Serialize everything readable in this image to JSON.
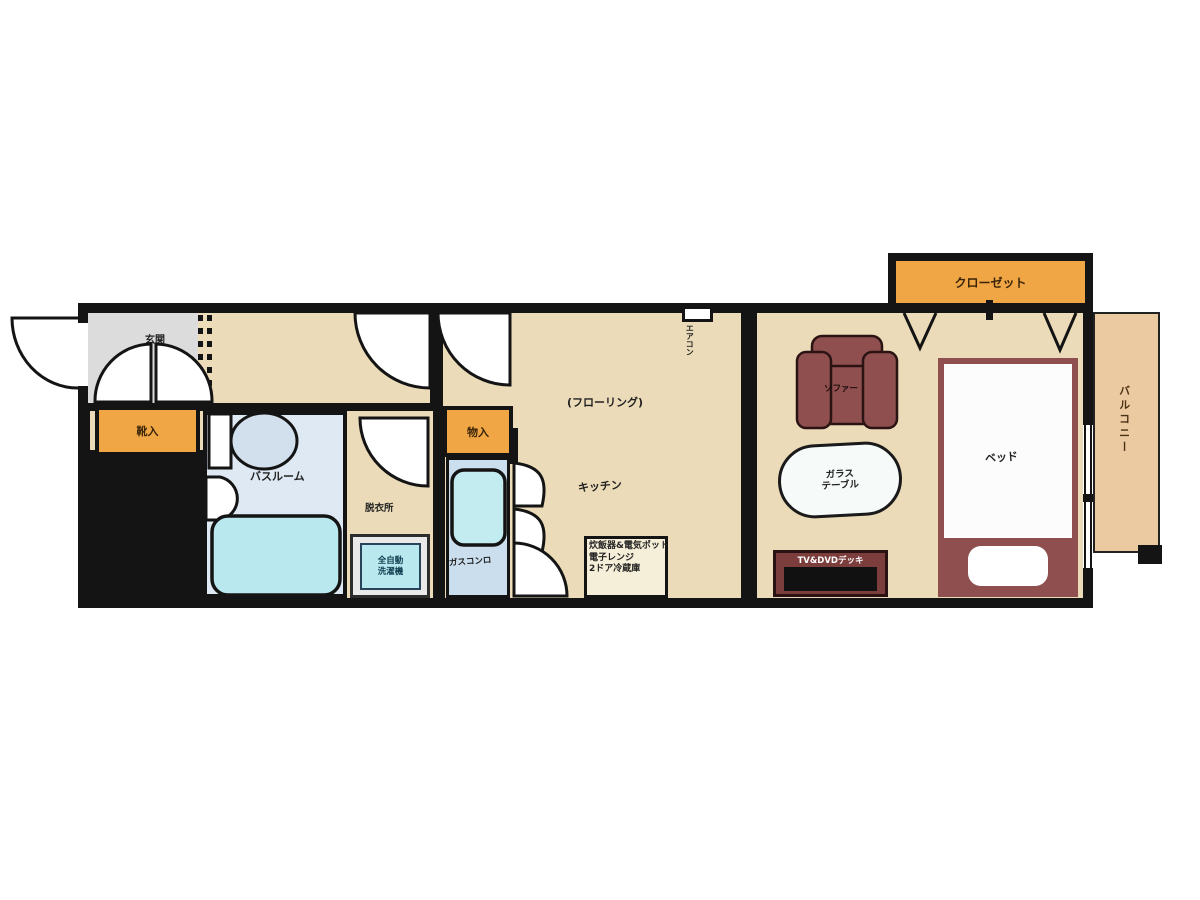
{
  "title": "apartment-floor-plan",
  "labels": {
    "entrance": "玄関",
    "shoe_cabinet": "靴入",
    "bathroom": "バスルーム",
    "changing_room": "脱衣所",
    "washer_line1": "全自動",
    "washer_line2": "洗濯機",
    "gas_stove": "ガスコンロ",
    "storage": "物入",
    "flooring": "(フローリング)",
    "kitchen": "キッチン",
    "air_conditioner": "エアコン",
    "appliance_line1": "炊飯器&電気ポット",
    "appliance_line2": "電子レンジ",
    "appliance_line3": "2ドア冷蔵庫",
    "closet": "クローゼット",
    "sofa": "ソファー",
    "glass_table_line1": "ガラス",
    "glass_table_line2": "テーブル",
    "bed": "ベッド",
    "tv_deck": "TV&DVDデッキ",
    "balcony": "バルコニー"
  },
  "palette": {
    "wall": "#141414",
    "floor": "#ebdbb8",
    "entrance-grey": "#dcdcdc",
    "orange": "#f0a644",
    "bath-floor": "#dfe9f3",
    "aqua": "#b9e9ee",
    "stove-floor": "#cadeed",
    "maroon": "#8f4f4f",
    "maroon-dark": "#7c3d3d",
    "balcony-tan": "#ebc9a1",
    "ink": "#222222"
  }
}
